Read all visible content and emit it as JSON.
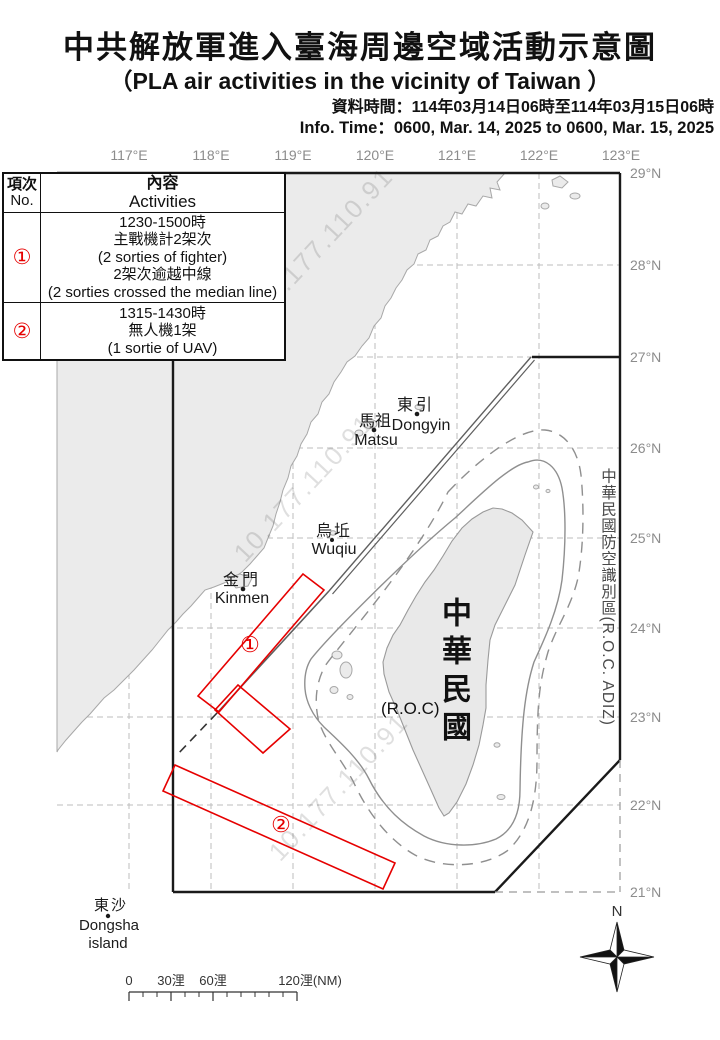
{
  "header": {
    "title_zh": "中共解放軍進入臺海周邊空域活動示意圖",
    "title_en": "（PLA air activities in the vicinity of Taiwan ）",
    "info_time_zh": "資料時間：114年03月14日06時至114年03月15日06時",
    "info_time_en": "Info. Time：0600, Mar. 14, 2025 to 0600, Mar. 15, 2025"
  },
  "table": {
    "col_no_zh": "項次",
    "col_no_en": "No.",
    "col_act_zh": "內容",
    "col_act_en": "Activities",
    "rows": [
      {
        "no": "①",
        "lines": [
          "1230-1500時",
          "主戰機計2架次",
          "(2 sorties of fighter)",
          "2架次逾越中線",
          "(2 sorties crossed the median line)"
        ]
      },
      {
        "no": "②",
        "lines": [
          "1315-1430時",
          "無人機1架",
          "(1 sortie of UAV)"
        ]
      }
    ]
  },
  "map": {
    "lon_labels": [
      "117°E",
      "118°E",
      "119°E",
      "120°E",
      "121°E",
      "122°E",
      "123°E"
    ],
    "lat_labels": [
      "29°N",
      "28°N",
      "27°N",
      "26°N",
      "25°N",
      "24°N",
      "23°N",
      "22°N",
      "21°N"
    ],
    "places": {
      "dongyin_zh": "東引",
      "dongyin_en": "Dongyin",
      "matsu_zh": "馬祖",
      "matsu_en": "Matsu",
      "wuqiu_zh": "烏坵",
      "wuqiu_en": "Wuqiu",
      "kinmen_zh": "金門",
      "kinmen_en": "Kinmen",
      "dongsha_zh": "東沙",
      "dongsha_en1": "Dongsha",
      "dongsha_en2": "island"
    },
    "roc_zh": "中華民國",
    "roc_en": "(R.O.C)",
    "adiz_label": "中華民國防空識別區(R.O.C. ADIZ)",
    "marker_1": "①",
    "marker_2": "②",
    "watermark": "10.177.110.91",
    "compass_n": "N",
    "scale_labels": [
      "0",
      "30浬",
      "60浬",
      "120浬(NM)"
    ]
  },
  "colors": {
    "activity_red": "#e60000",
    "land_gray": "#ebebeb",
    "coast_gray": "#a8a8a8",
    "grid_gray": "#bdbdbd",
    "boundary_black": "#1a1a1a",
    "axis_label_gray": "#8c8c8c"
  }
}
